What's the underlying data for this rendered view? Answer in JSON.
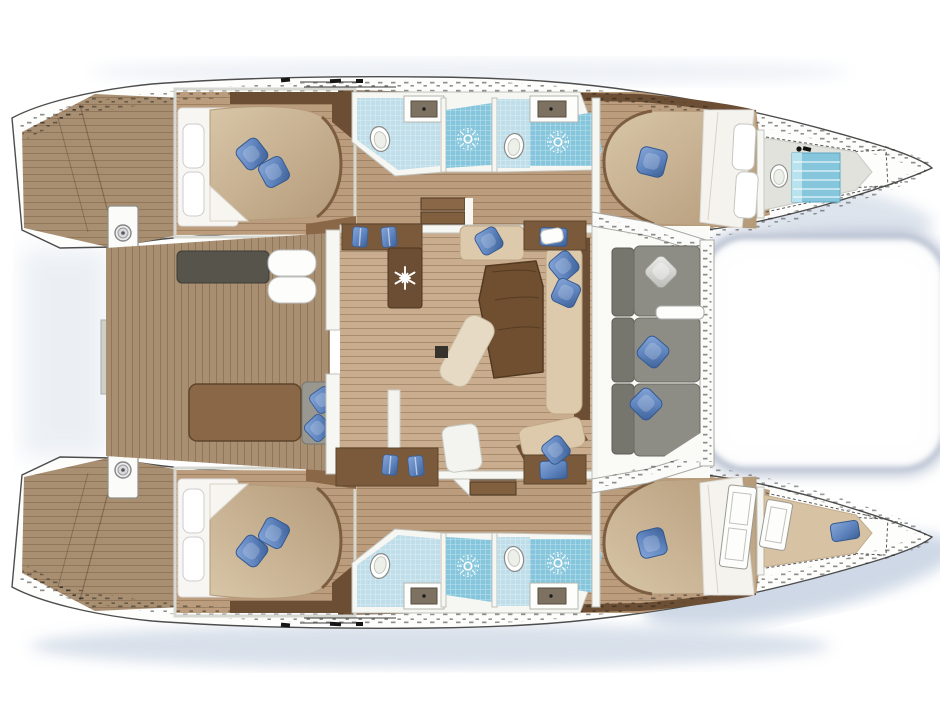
{
  "diagram": {
    "type": "yacht-floor-plan",
    "subject": "Catamaran sailing yacht - top view interior layout",
    "orientation": "bows-right",
    "style": "rendered architectural plan, no text labels"
  },
  "colors": {
    "page": "#ffffff",
    "hull_white": "#fdfdfc",
    "outline": "#4d4d4d",
    "teak": "#a98f72",
    "hull_floor": "#bb9d7e",
    "salon_floor": "#c9ad8e",
    "dark_wood": "#6b4e33",
    "mid_wood": "#8a6746",
    "table_wood": "#6f4f30",
    "counter_wood": "#7b5a3b",
    "duvet_tan": "#cdb795",
    "sheet_white": "#f7f6f2",
    "pillow_blue": "#5e83bd",
    "pillow_blue_deep": "#3c5f95",
    "pillow_silver": "#d8d8d4",
    "sofa_gray": "#8e8d85",
    "sofa_gray_back": "#77766e",
    "seat_charcoal": "#56544b",
    "bench_gray": "#999890",
    "wall_white": "#f6f6f2",
    "tile_blue": "#bfdeea",
    "shower_blue": "#85c6dd",
    "trampoline_shade": "#a9b4c9",
    "shadow_blue": "#bac7da",
    "arrow_red": "#c11f00"
  },
  "vessel": {
    "hulls": [
      {
        "id": "port",
        "position": "top",
        "rooms": [
          {
            "name": "transom-steps",
            "items": [
              "teak-deck"
            ]
          },
          {
            "name": "aft-cabin",
            "items": [
              "island-double-bed",
              "white-pillow",
              "white-pillow",
              "blue-pillow",
              "blue-pillow",
              "wardrobe"
            ]
          },
          {
            "name": "aft-bathroom",
            "items": [
              "toilet",
              "sink",
              "shower-sunburst"
            ]
          },
          {
            "name": "forward-bathroom",
            "items": [
              "toilet",
              "sink",
              "shower-sunburst"
            ]
          },
          {
            "name": "forward-cabin",
            "items": [
              "island-double-bed",
              "blue-pillow",
              "headboard-pillows"
            ]
          },
          {
            "name": "forepeak-crew-head",
            "items": [
              "toilet",
              "blue-berth-pad",
              "windlass",
              "deck-hatch"
            ]
          }
        ]
      },
      {
        "id": "starboard",
        "position": "bottom",
        "rooms": [
          {
            "name": "transom-steps",
            "items": [
              "teak-deck"
            ]
          },
          {
            "name": "aft-cabin",
            "items": [
              "island-double-bed",
              "white-pillow",
              "white-pillow",
              "blue-pillow",
              "blue-pillow",
              "wardrobe"
            ]
          },
          {
            "name": "aft-bathroom",
            "items": [
              "toilet",
              "sink",
              "shower-sunburst"
            ]
          },
          {
            "name": "forward-bathroom",
            "items": [
              "toilet",
              "sink",
              "shower-sunburst"
            ]
          },
          {
            "name": "forward-cabin",
            "items": [
              "island-double-bed",
              "blue-pillow",
              "locker-doors"
            ]
          },
          {
            "name": "forepeak-crew-berth",
            "items": [
              "locker-door",
              "locker-door",
              "blue-pillow",
              "deck-hatch"
            ]
          }
        ]
      }
    ],
    "bridgedeck": [
      {
        "name": "aft-crossbeam",
        "items": [
          "winch",
          "winch",
          "gray-sunpad"
        ]
      },
      {
        "name": "aft-cockpit",
        "items": [
          "teak-sole",
          "charcoal-bench",
          "white-cushions",
          "cockpit-table",
          "gray-bench",
          "blue-pillow",
          "blue-pillow",
          "sliding-door-arrow"
        ]
      },
      {
        "name": "salon",
        "items": [
          "galley-counter",
          "blue-towels",
          "fridge-freezer-snowflake",
          "galley-island",
          "stairs-port",
          "stairs-starboard",
          "dining-table",
          "ottoman",
          "cream-sofa",
          "chart-table",
          "chart-table",
          "blue-pillows",
          "floor-hatch"
        ]
      },
      {
        "name": "forward-cockpit",
        "items": [
          "u-sofa-gray",
          "silver-pillow",
          "blue-pillow",
          "blue-pillow",
          "armrest"
        ]
      },
      {
        "name": "trampoline",
        "items": []
      }
    ]
  },
  "icons": [
    "snowflake-icon",
    "shower-sunburst-icon",
    "toilet-icon",
    "sink-icon",
    "winch-icon",
    "sliding-door-arrow-icon",
    "windlass-icon",
    "hatch-outline-icon",
    "cleat-icon"
  ]
}
